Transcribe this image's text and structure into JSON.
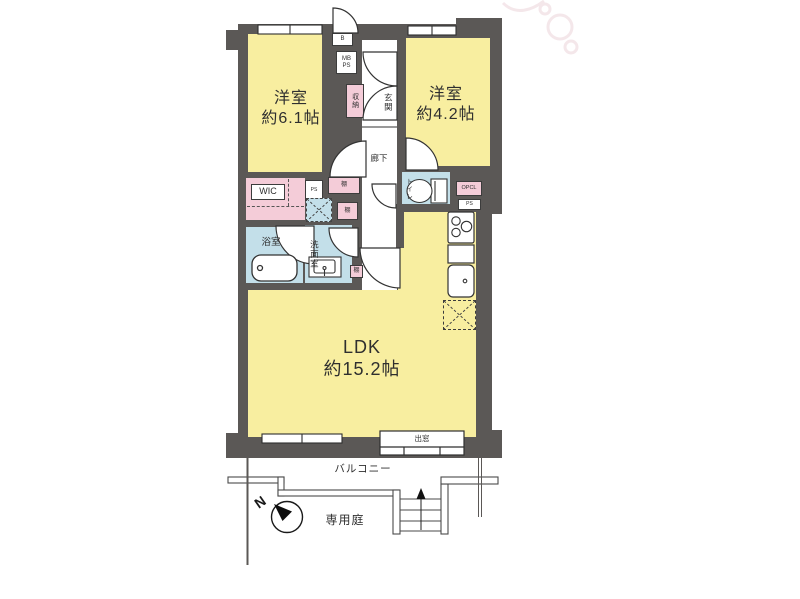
{
  "title": "マンション間取り図",
  "rooms": {
    "bedroom1": {
      "name": "洋室",
      "size": "約6.1帖"
    },
    "bedroom2": {
      "name": "洋室",
      "size": "約4.2帖"
    },
    "ldk": {
      "name": "LDK",
      "size": "約15.2帖"
    },
    "entrance": "玄関",
    "hallway": "廊下",
    "closet": "収納",
    "wic": "WIC",
    "bath": "浴室",
    "washroom": "洗面室",
    "toilet": "トイレ",
    "balcony": "バルコニー",
    "garden": "専用庭",
    "bay_window": "出窓"
  },
  "labels": {
    "b": "B",
    "mb": "MB",
    "ps": "PS",
    "opcl": "OPCL",
    "shelf": "棚",
    "north": "N"
  },
  "icons": [
    "bathtub-icon",
    "washbasin-icon",
    "toilet-icon",
    "stove-icon",
    "kitchen-sink-icon",
    "washer-place-icon",
    "fridge-place-icon",
    "stairs-icon",
    "compass-icon",
    "door-arc-icon"
  ],
  "colors": {
    "wall": "#5b5856",
    "room_yellow": "#f8eea0",
    "room_pink": "#f4ccd8",
    "room_blue": "#c3dfe9",
    "line": "#333333"
  }
}
